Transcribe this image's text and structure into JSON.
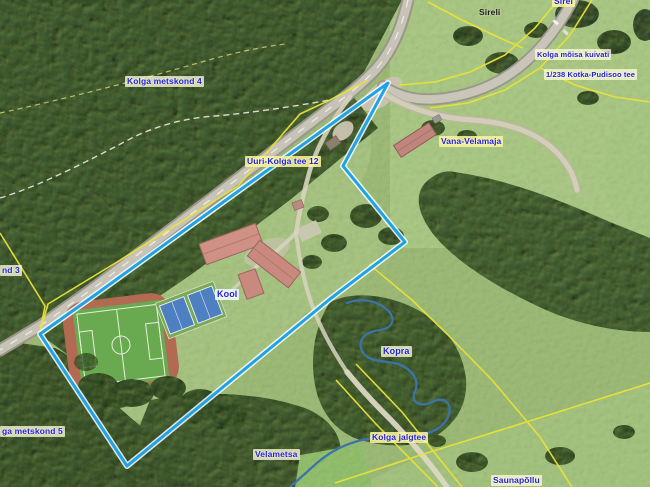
{
  "map": {
    "labels": {
      "sirel": "Sirel",
      "sireli": "Sireli",
      "kolga_moisa_kuivati": "Kolga mõisa kuivati",
      "kotka_pudisoo_tee": "1/238 Kotka-Pudisoo tee",
      "kolga_metskond_4": "Kolga metskond 4",
      "uuri_kolga_tee_12": "Uuri-Kolga tee 12",
      "vana_velamaja": "Vana-Velamaja",
      "kool": "Kool",
      "kopra": "Kopra",
      "metskond_edge_left": "nd 3",
      "kolga_metskond_5": "ga metskond 5",
      "velametsa": "Velametsa",
      "kolga_jalgtee": "Kolga jalgtee",
      "saunapollu": "Saunapõllu"
    },
    "colors": {
      "selected_parcel": "#1fa3e6",
      "cadastral_line": "#e8e337",
      "label_text": "#2222cc",
      "water": "#3c74a8"
    }
  }
}
